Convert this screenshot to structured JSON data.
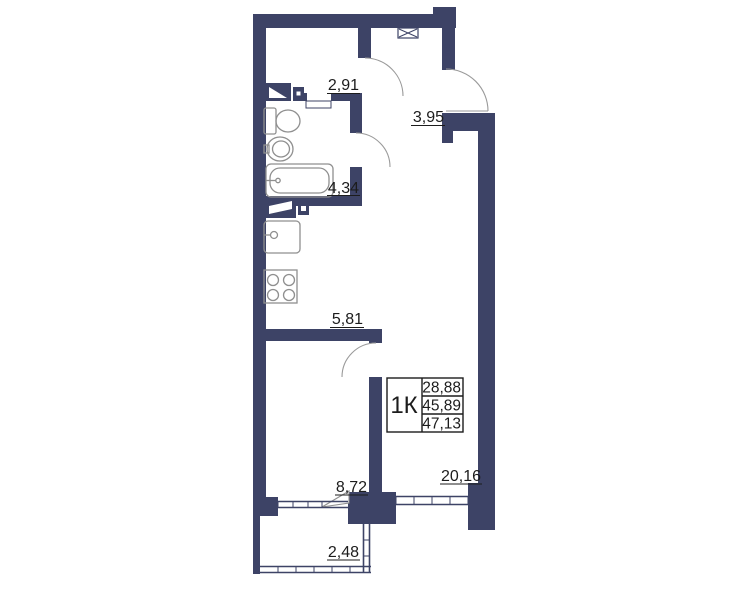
{
  "plan": {
    "legend": {
      "type_label": "1К",
      "living_area": "28,88",
      "total_area": "45,89",
      "total_with_balcony": "47,13"
    },
    "rooms": [
      {
        "name": "hallway",
        "area": "2,91"
      },
      {
        "name": "corridor",
        "area": "3,95"
      },
      {
        "name": "bathroom",
        "area": "4,34"
      },
      {
        "name": "kitchen-niche",
        "area": "5,81"
      },
      {
        "name": "bedroom",
        "area": "8,72"
      },
      {
        "name": "living-room",
        "area": "20,16"
      },
      {
        "name": "balcony",
        "area": "2,48"
      }
    ],
    "annotations": {
      "vent_shaft_label": "3М"
    },
    "colors": {
      "wall": "#3d4366",
      "label_text": "#1c1c1c",
      "fixture_outline": "#8f8f8f",
      "background": "#ffffff"
    }
  }
}
